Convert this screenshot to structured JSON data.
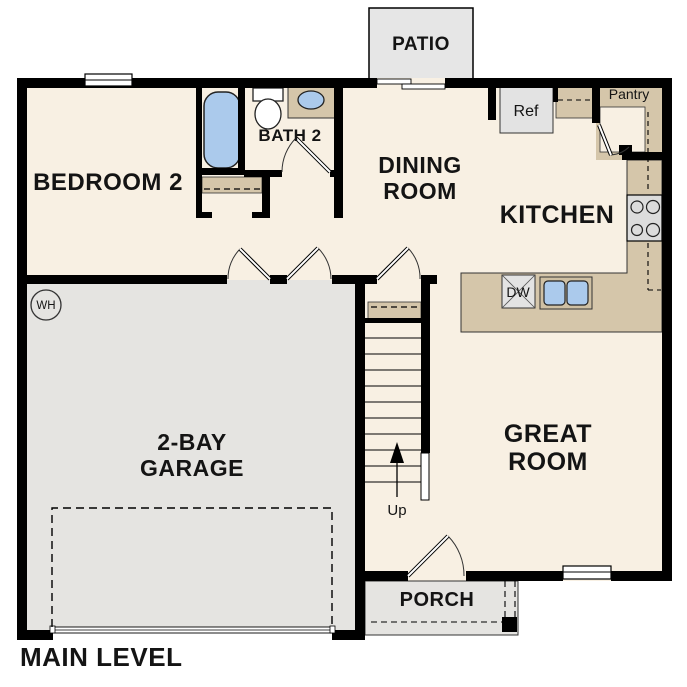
{
  "plan": {
    "title": "MAIN LEVEL",
    "labels": {
      "bedroom2": "BEDROOM 2",
      "bath2": "BATH 2",
      "dining_line1": "DINING",
      "dining_line2": "ROOM",
      "kitchen": "KITCHEN",
      "great_line1": "GREAT",
      "great_line2": "ROOM",
      "garage_line1": "2-BAY",
      "garage_line2": "GARAGE",
      "patio": "PATIO",
      "porch": "PORCH",
      "pantry": "Pantry",
      "refrigerator": "Ref",
      "dishwasher": "DW",
      "water_heater": "WH",
      "stairs_up": "Up"
    },
    "colors": {
      "wall": "#000000",
      "floor_cream": "#f8f0e3",
      "garage_gray": "#e5e4e1",
      "counter_tan": "#d5c6aa",
      "fixture_blue": "#abcaec",
      "appliance_gray": "#e3e3e3"
    }
  }
}
